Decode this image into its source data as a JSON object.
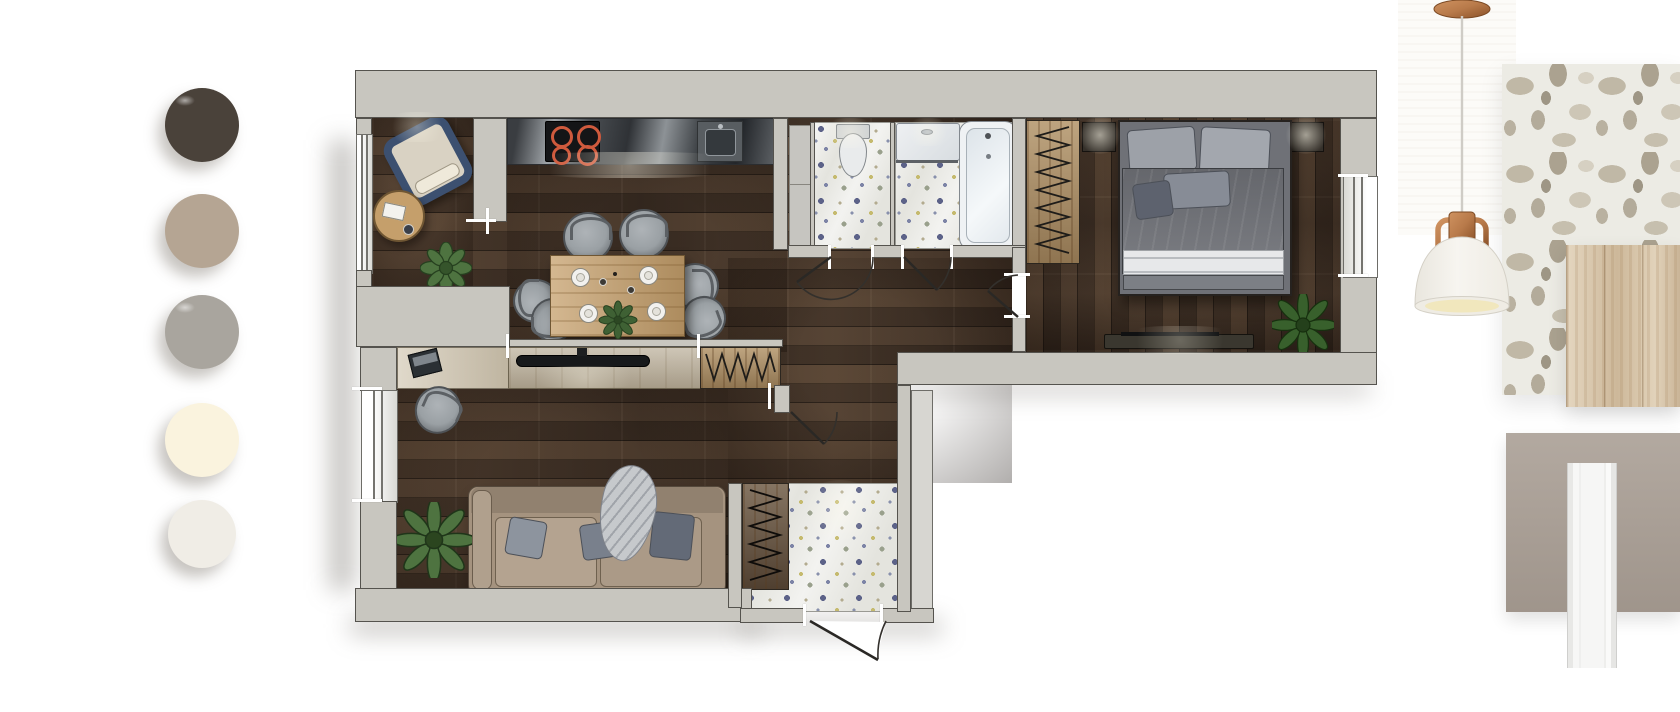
{
  "board": {
    "kind": "interior-design-mood-board",
    "background": "#ffffff"
  },
  "palette": {
    "swatches": [
      {
        "name": "espresso-brown",
        "color": "#4a423a"
      },
      {
        "name": "warm-taupe",
        "color": "#b5a593"
      },
      {
        "name": "stone-gray",
        "color": "#a9a59e"
      },
      {
        "name": "cream",
        "color": "#faf3de"
      },
      {
        "name": "porcelain-white",
        "color": "#f0ede6"
      }
    ]
  },
  "floor_plan": {
    "colors": {
      "wall": "#c8c6bf",
      "wall_outline": "#55534e",
      "wood_floor": "#4a3b30",
      "tile_floor": "#e4e4de",
      "light_wood": "#c59f6b",
      "counter_dark": "#3a3e42",
      "sofa": "#a5937f",
      "chair_gray": "#9aa0a4",
      "bed_blanket": "#73757b",
      "armchair_navy": "#3c5070",
      "plant_green": "#4e7340",
      "burner_red": "#cf5a3d",
      "hanger_symbol": "#1e1c19"
    },
    "rooms": [
      {
        "name": "reading-nook",
        "furniture": [
          "armchair",
          "round-side-table",
          "book",
          "plant"
        ]
      },
      {
        "name": "kitchen-dining",
        "furniture": [
          "kitchen-counter",
          "cooktop",
          "sink",
          "dining-table",
          "dining-chairs",
          "plates",
          "centerpiece-plant"
        ]
      },
      {
        "name": "living-room",
        "furniture": [
          "desk",
          "laptop",
          "office-chair",
          "tv-console",
          "tv",
          "hanger-wardrobe",
          "sofa",
          "pillows",
          "throw-blanket",
          "floor-plant"
        ]
      },
      {
        "name": "hallway",
        "furniture": [
          "interior-doors"
        ]
      },
      {
        "name": "entry",
        "furniture": [
          "entry-closet",
          "front-door"
        ]
      },
      {
        "name": "wc",
        "furniture": [
          "toilet",
          "tall-cabinet"
        ]
      },
      {
        "name": "bathroom",
        "furniture": [
          "shower-tray",
          "bathtub"
        ]
      },
      {
        "name": "bedroom",
        "furniture": [
          "double-bed",
          "pillows",
          "nightstand-left",
          "nightstand-right",
          "table-lamps",
          "hanger-wardrobe",
          "media-console",
          "plant"
        ]
      }
    ],
    "windows": [
      "nook-left-window",
      "living-left-window",
      "bedroom-right-window"
    ]
  },
  "materials": [
    {
      "name": "terrazzo-tile-sample",
      "base_color": "#ecebe4"
    },
    {
      "name": "light-oak-wood-sample",
      "base_color": "#d9c7ab"
    },
    {
      "name": "taupe-paint-sample",
      "base_color": "#a89d93"
    },
    {
      "name": "white-door-trim-sample",
      "base_color": "#f4f4f3"
    }
  ],
  "pendant_lamp": {
    "name": "copper-pendant-lamp",
    "shade_color": "#f5f3ed",
    "finish_color": "#b87a4a",
    "inner_color": "#f1e7bd",
    "cord_color": "#cfccc6"
  }
}
